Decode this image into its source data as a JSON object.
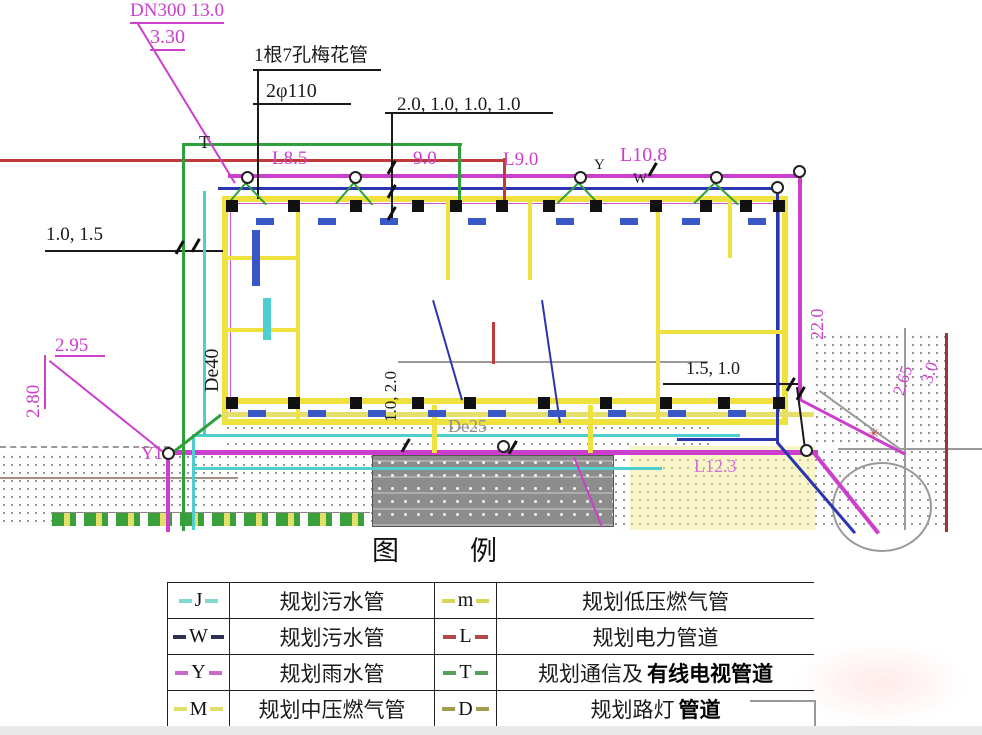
{
  "legend": {
    "title": "图　例",
    "left_rows": [
      {
        "symbol": "J",
        "color": "#7fd9cf",
        "label": "规划污水管",
        "bold": ""
      },
      {
        "symbol": "W",
        "color": "#2f2f52",
        "label": "规划污水管",
        "bold": ""
      },
      {
        "symbol": "Y",
        "color": "#c76bc7",
        "label": "规划雨水管",
        "bold": ""
      },
      {
        "symbol": "M",
        "color": "#e0dd6a",
        "label": "规划中压燃气管",
        "bold": ""
      }
    ],
    "right_rows": [
      {
        "symbol": "m",
        "color": "#d6d65a",
        "label": "规划低压燃气管",
        "bold": ""
      },
      {
        "symbol": "L",
        "color": "#b04a4a",
        "label": "规划电力管道",
        "bold": ""
      },
      {
        "symbol": "T",
        "color": "#57a05c",
        "label": "规划通信及",
        "bold": "有线电视管道"
      },
      {
        "symbol": "D",
        "color": "#a39b4d",
        "label": "规划路灯",
        "bold": "管道"
      }
    ]
  },
  "plan_labels": {
    "dn300": "DN300 13.0",
    "elev_330": "3.30",
    "plum_pipe": "1根7孔梅花管",
    "dia110": "2φ110",
    "dims_top": "2.0, 1.0, 1.0, 1.0",
    "t_mark": "T",
    "l85": "L8.5",
    "n90": "9.0",
    "l90": "L9.0",
    "y_mark": "Y",
    "l108": "L10.8",
    "w_mark": "W",
    "dims_left": "1.0, 1.5",
    "e295": "2.95",
    "e280": "2.80",
    "de40": "De40",
    "y1": "Y1",
    "dims_mid": "1.0, 2.0",
    "de25": "De25",
    "dims_right": "1.5, 1.0",
    "v220": "22.0",
    "e265": "2.65",
    "e30": "3.0",
    "l123": "L12.3"
  },
  "colors": {
    "magenta": "#cc3ecc",
    "light_magenta": "#d96ad9",
    "green": "#2fa03c",
    "red": "#c03a3a",
    "blue": "#2a35b0",
    "cyan": "#4ecfcf",
    "yellow": "#f0e23e",
    "yellow2": "#e6de6a",
    "navy": "#2f2f52",
    "dark_red": "#a03434",
    "gray": "#9a9a9a",
    "mid_gray": "#8f8f8f",
    "brown": "#a89080",
    "black": "#1a1a1a"
  }
}
